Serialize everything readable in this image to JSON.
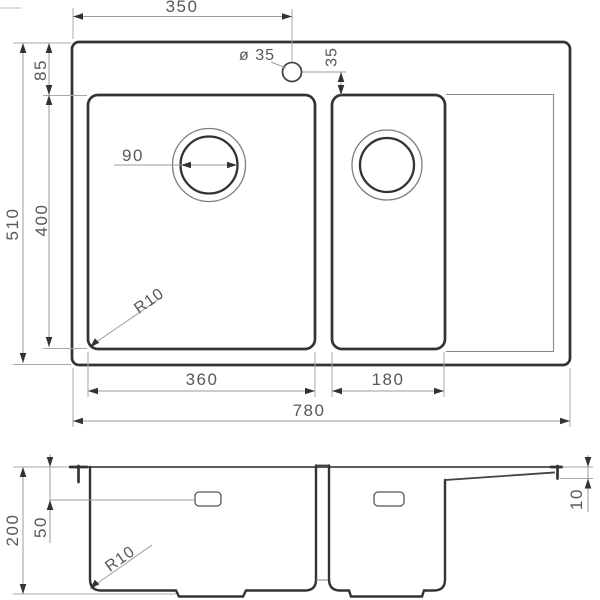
{
  "plan_view": {
    "dims": {
      "top_width": "350",
      "faucet_diameter": "ø 35",
      "faucet_offset": "35",
      "rim_inset": "85",
      "overall_depth": "510",
      "bowl_depth": "400",
      "drain_diameter": "90",
      "corner_radius": "R10",
      "main_bowl_width": "360",
      "half_bowl_width": "180",
      "overall_width": "780"
    }
  },
  "section_view": {
    "dims": {
      "bowl_depth": "200",
      "overflow_offset": "50",
      "corner_radius": "R10",
      "edge_drop": "10"
    }
  },
  "colors": {
    "outline": "#333333",
    "dimension_line": "#9b9b9b",
    "text": "#585858",
    "background": "#ffffff"
  }
}
